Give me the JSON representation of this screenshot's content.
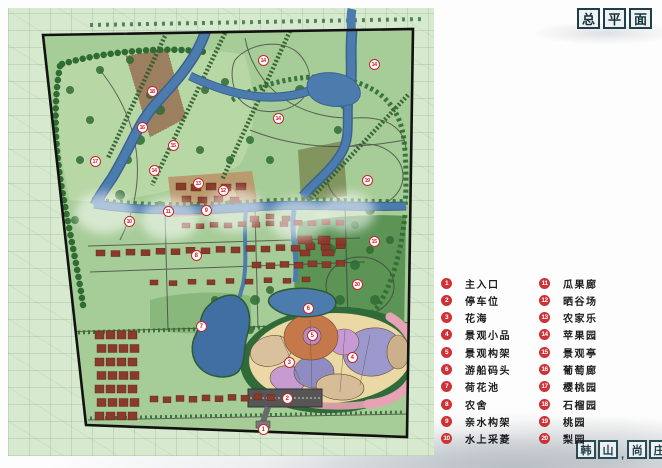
{
  "title": {
    "boxed_chars": [
      "总",
      "平",
      "面"
    ]
  },
  "seal": {
    "boxed_chars": [
      "韩",
      "山",
      "尚",
      "庄"
    ],
    "separator": ","
  },
  "legend": {
    "column1": [
      {
        "num": "1",
        "label": "主入口"
      },
      {
        "num": "2",
        "label": "停车位"
      },
      {
        "num": "3",
        "label": "花海"
      },
      {
        "num": "4",
        "label": "景观小品"
      },
      {
        "num": "5",
        "label": "景观构架"
      },
      {
        "num": "6",
        "label": "游船码头"
      },
      {
        "num": "7",
        "label": "荷花池"
      },
      {
        "num": "8",
        "label": "农舍"
      },
      {
        "num": "9",
        "label": "亲水构架"
      },
      {
        "num": "10",
        "label": "水上采菱"
      }
    ],
    "column2": [
      {
        "num": "11",
        "label": "瓜果廊"
      },
      {
        "num": "12",
        "label": "晒谷场"
      },
      {
        "num": "13",
        "label": "农家乐"
      },
      {
        "num": "14",
        "label": "苹果园"
      },
      {
        "num": "15",
        "label": "景观亭"
      },
      {
        "num": "16",
        "label": "葡萄廊"
      },
      {
        "num": "17",
        "label": "樱桃园"
      },
      {
        "num": "18",
        "label": "石榴园"
      },
      {
        "num": "19",
        "label": "桃园"
      },
      {
        "num": "20",
        "label": "梨园"
      }
    ]
  },
  "map": {
    "markers": [
      {
        "num": "1",
        "x": 263,
        "y": 429
      },
      {
        "num": "2",
        "x": 287,
        "y": 398
      },
      {
        "num": "3",
        "x": 289,
        "y": 362
      },
      {
        "num": "4",
        "x": 352,
        "y": 357
      },
      {
        "num": "5",
        "x": 312,
        "y": 335
      },
      {
        "num": "6",
        "x": 308,
        "y": 308
      },
      {
        "num": "7",
        "x": 201,
        "y": 326
      },
      {
        "num": "8",
        "x": 196,
        "y": 255
      },
      {
        "num": "9",
        "x": 206,
        "y": 210
      },
      {
        "num": "10",
        "x": 129,
        "y": 221
      },
      {
        "num": "11",
        "x": 168,
        "y": 211
      },
      {
        "num": "12",
        "x": 223,
        "y": 190
      },
      {
        "num": "13",
        "x": 198,
        "y": 183
      },
      {
        "num": "14",
        "x": 263,
        "y": 60
      },
      {
        "num": "14",
        "x": 374,
        "y": 64
      },
      {
        "num": "14",
        "x": 278,
        "y": 118
      },
      {
        "num": "14",
        "x": 154,
        "y": 170
      },
      {
        "num": "15",
        "x": 173,
        "y": 145
      },
      {
        "num": "15",
        "x": 374,
        "y": 241
      },
      {
        "num": "16",
        "x": 142,
        "y": 127
      },
      {
        "num": "17",
        "x": 95,
        "y": 161
      },
      {
        "num": "18",
        "x": 152,
        "y": 91
      },
      {
        "num": "19",
        "x": 367,
        "y": 180
      },
      {
        "num": "20",
        "x": 357,
        "y": 284
      }
    ]
  },
  "colors": {
    "marker_red": "#c6262c",
    "legend_red": "#ce3136",
    "title_ink": "#1d3e4a",
    "site_green": "#a6cc97",
    "water_blue": "#4c7cad"
  }
}
